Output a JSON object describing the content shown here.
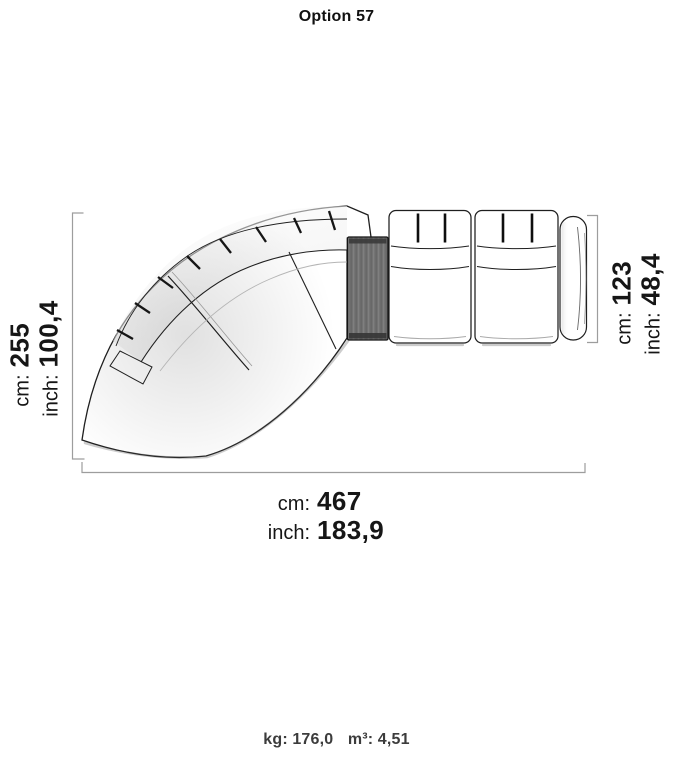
{
  "title": "Option 57",
  "dimensions": {
    "left": {
      "unit1": "cm:",
      "value1": "255",
      "unit2": "inch:",
      "value2": "100,4"
    },
    "right": {
      "unit1": "cm:",
      "value1": "123",
      "unit2": "inch:",
      "value2": "48,4"
    },
    "bottom": {
      "unit1": "cm:",
      "value1": "467",
      "unit2": "inch:",
      "value2": "183,9"
    }
  },
  "footer": {
    "weight_unit": "kg:",
    "weight_value": "176,0",
    "volume_unit": "m³:",
    "volume_value": "4,51"
  },
  "diagram": {
    "description": "Top view of a curved sectional sofa: curved 3-segment chaise module, dark side table connector, two straight seat modules and a right armrest, with dimension brackets",
    "colors": {
      "outline": "#1f1f1f",
      "dim-line": "#9d9d9d",
      "text": "#161616",
      "footer-text": "#3c3c3c",
      "table-fill": "#727272",
      "bg": "#ffffff"
    }
  }
}
